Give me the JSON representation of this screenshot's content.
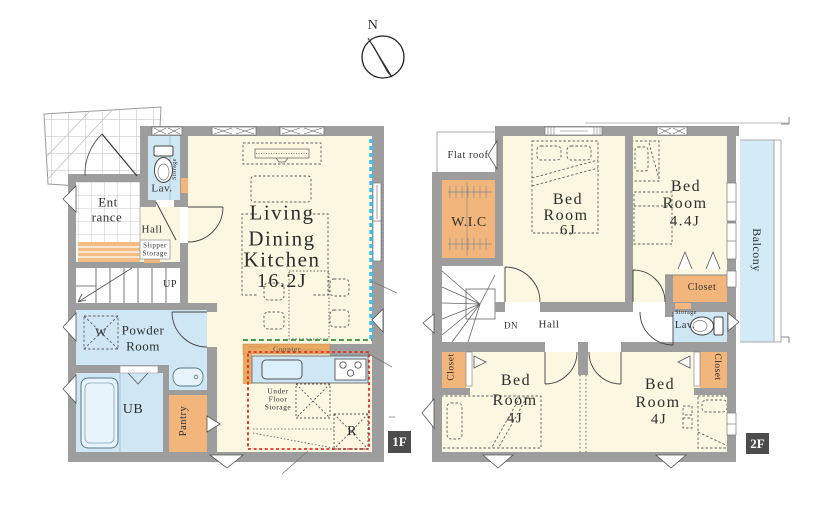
{
  "compass": {
    "north_label": "N"
  },
  "palette": {
    "floor_fill": "#fbf7e1",
    "wet_room_fill": "#cfe7f5",
    "storage_fill": "#f2b67c",
    "wall": "#9d9d9d",
    "balcony_fill": "#d3eaf7",
    "kitchen_zone_outline": "#e03127",
    "accent_cyan": "#3ec1ec",
    "accent_green": "#4e9a4e",
    "badge_bg": "#4c4c4c"
  },
  "floor1": {
    "badge": "1F",
    "entrance": {
      "l1": "Ent",
      "l2": "rance"
    },
    "hall": "Hall",
    "lavatory": "Lav.",
    "lavatory_storage": "Storage",
    "slipper_storage": {
      "l1": "Slipper",
      "l2": "Storage"
    },
    "stairs_up": "UP",
    "washer": "W",
    "powder_room": {
      "l1": "Powder",
      "l2": "Room"
    },
    "unit_bath": "UB",
    "pantry": "Pantry",
    "ldk": {
      "l1": "Living",
      "l2": "Dining",
      "l3": "Kitchen",
      "size": "16.2J"
    },
    "counter": "Counter",
    "under_floor_storage": {
      "l1": "Under",
      "l2": "Floor",
      "l3": "Storage"
    },
    "refrigerator": "R"
  },
  "floor2": {
    "badge": "2F",
    "flat_roof": "Flat roof",
    "walk_in_closet": "W.I.C",
    "bedroom_6j": {
      "l1": "Bed",
      "l2": "Room",
      "size": "6J"
    },
    "bedroom_44j": {
      "l1": "Bed",
      "l2": "Room",
      "size": "4.4J"
    },
    "balcony": "Balcony",
    "closet_main": "Closet",
    "lavatory_storage": "Storage",
    "lavatory": "Lav.",
    "stairs_down": "DN",
    "hall": "Hall",
    "closet_west": "Closet",
    "closet_east": "Closet",
    "bedroom_4j_west": {
      "l1": "Bed",
      "l2": "Room",
      "size": "4J"
    },
    "bedroom_4j_east": {
      "l1": "Bed",
      "l2": "Room",
      "size": "4J"
    }
  }
}
